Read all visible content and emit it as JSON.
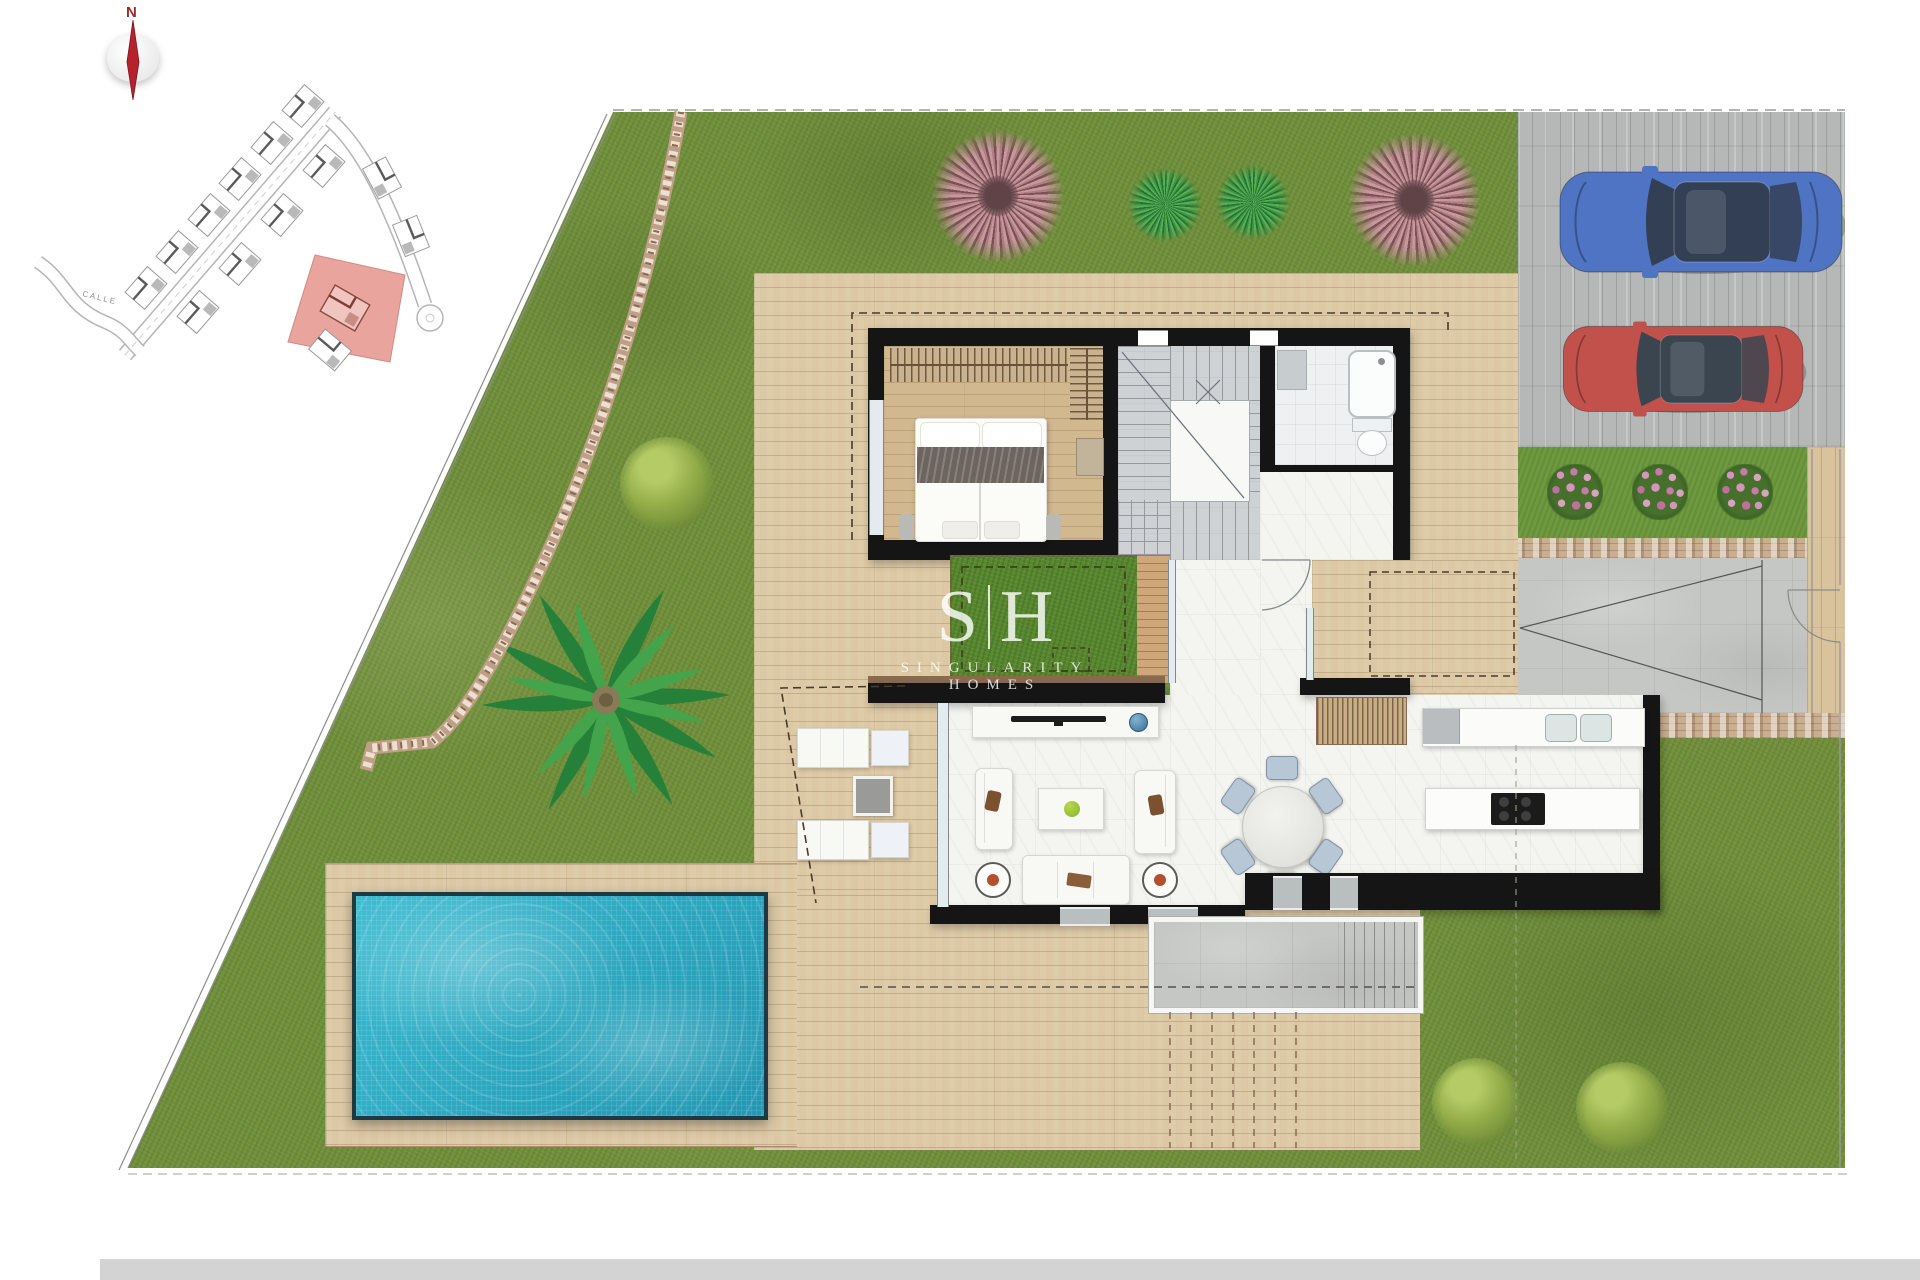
{
  "compass": {
    "label": "N"
  },
  "site_map": {
    "street_label": "CALLE",
    "highlight_color": "#e9a59d"
  },
  "watermark": {
    "initial_left": "S",
    "initial_right": "H",
    "brand": "SINGULARITY HOMES"
  },
  "palette": {
    "grass": "#71903c",
    "deck_wood": "#dcc8a4",
    "interior_wood": "#d2b88f",
    "wall": "#151515",
    "white_tile": "#f4f4f1",
    "stair_tile": "#ced2d5",
    "terrace_stone": "#c5c7c4",
    "driveway_concrete": "#b5b8b7",
    "pool_water": "#2fb4c9",
    "courtyard_grass": "#57872f",
    "pink_tree": "#c992a0",
    "palm_green": "#2d8c3e"
  },
  "vehicles": {
    "blue_car": {
      "body": "#4f74c4",
      "glass": "#333f55"
    },
    "red_car": {
      "body": "#c2504b",
      "glass": "#3a4550"
    }
  }
}
